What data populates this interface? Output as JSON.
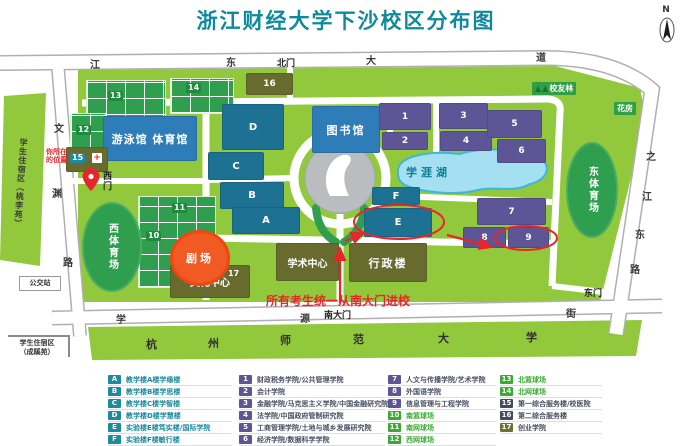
{
  "title": "浙江财经大学下沙校区分布图",
  "compass_label": "N",
  "colors": {
    "title_teal": "#0e8a9c",
    "campus_green": "#92c83c",
    "teal_building": "#1d7293",
    "blue_building": "#2e7cb8",
    "purple_building": "#5d5596",
    "olive_building": "#686b2e",
    "court_green": "#2f9e4f",
    "lake_blue": "#a5dff2",
    "accent_red": "#e8262a",
    "legend_green": "#3aaa35",
    "legend_dark": "#474a5e"
  },
  "map": {
    "labels": {
      "pool_gym": "游泳馆 体育馆",
      "library": "图书馆",
      "west_stadium": "西体育场",
      "east_stadium": "东体育场",
      "lake": "学涯湖",
      "theater": "剧场",
      "culture_center": "文化中心",
      "academic_center": "学术中心",
      "admin_building": "行政楼",
      "alumni_forest": "校友林",
      "greenhouse": "花房",
      "bus_stop": "公交站",
      "north_gate": "北门",
      "west_gate": "西门",
      "south_gate": "南大门",
      "east_gate": "东门",
      "dorm_left": "学生住宿区（桃李苑）",
      "dorm_bottom_line1": "学生住宿区",
      "dorm_bottom_line2": "（成蹊苑）",
      "you_are_here_line1": "你所在",
      "you_are_here_line2": "的位置",
      "notice": "所有考生统一从南大门进校"
    },
    "roads": {
      "north": [
        "江",
        "东",
        "大",
        "道"
      ],
      "west": [
        "文",
        "渊",
        "路"
      ],
      "east": [
        "之",
        "江",
        "东",
        "路"
      ],
      "south_street": [
        "学",
        "源",
        "街"
      ],
      "south_univ": [
        "杭",
        "州",
        "师",
        "范",
        "大",
        "学"
      ]
    },
    "marks": {
      "A": "A",
      "B": "B",
      "C": "C",
      "D": "D",
      "E": "E",
      "F": "F",
      "n1": "1",
      "n2": "2",
      "n3": "3",
      "n4": "4",
      "n5": "5",
      "n6": "6",
      "n7": "7",
      "n8": "8",
      "n9": "9",
      "n10": "10",
      "n11": "11",
      "n12": "12",
      "n13": "13",
      "n14": "14",
      "n15": "15",
      "n16": "16",
      "n17": "17"
    }
  },
  "legend": {
    "col1": [
      {
        "id": "A",
        "label": "教学楼A楼学缘楼"
      },
      {
        "id": "B",
        "label": "教学楼B楼学思楼"
      },
      {
        "id": "C",
        "label": "教学楼C楼学智楼"
      },
      {
        "id": "D",
        "label": "教学楼D楼学慧楼"
      },
      {
        "id": "E",
        "label": "实验楼E楼笃实楼/国际学院"
      },
      {
        "id": "F",
        "label": "实验楼F楼敏行楼"
      }
    ],
    "col2": [
      {
        "id": "1",
        "label": "财政税务学院/公共管理学院"
      },
      {
        "id": "2",
        "label": "会计学院"
      },
      {
        "id": "3",
        "label": "金融学院/马克思主义学院/中国金融研究院"
      },
      {
        "id": "4",
        "label": "法学院/中国政府管制研究院"
      },
      {
        "id": "5",
        "label": "工商管理学院/土地与城乡发展研究院"
      },
      {
        "id": "6",
        "label": "经济学院/数据科学学院"
      }
    ],
    "col3": [
      {
        "id": "7",
        "label": "人文与传播学院/艺术学院"
      },
      {
        "id": "8",
        "label": "外国语学院"
      },
      {
        "id": "9",
        "label": "信息管理与工程学院"
      },
      {
        "id": "10",
        "label": "南篮球场"
      },
      {
        "id": "11",
        "label": "南网球场"
      },
      {
        "id": "12",
        "label": "西网球场"
      }
    ],
    "col4": [
      {
        "id": "13",
        "label": "北篮球场"
      },
      {
        "id": "14",
        "label": "北网球场"
      },
      {
        "id": "15",
        "label": "第一综合服务楼/校医院"
      },
      {
        "id": "16",
        "label": "第二综合服务楼"
      },
      {
        "id": "17",
        "label": "创业学院"
      }
    ]
  }
}
